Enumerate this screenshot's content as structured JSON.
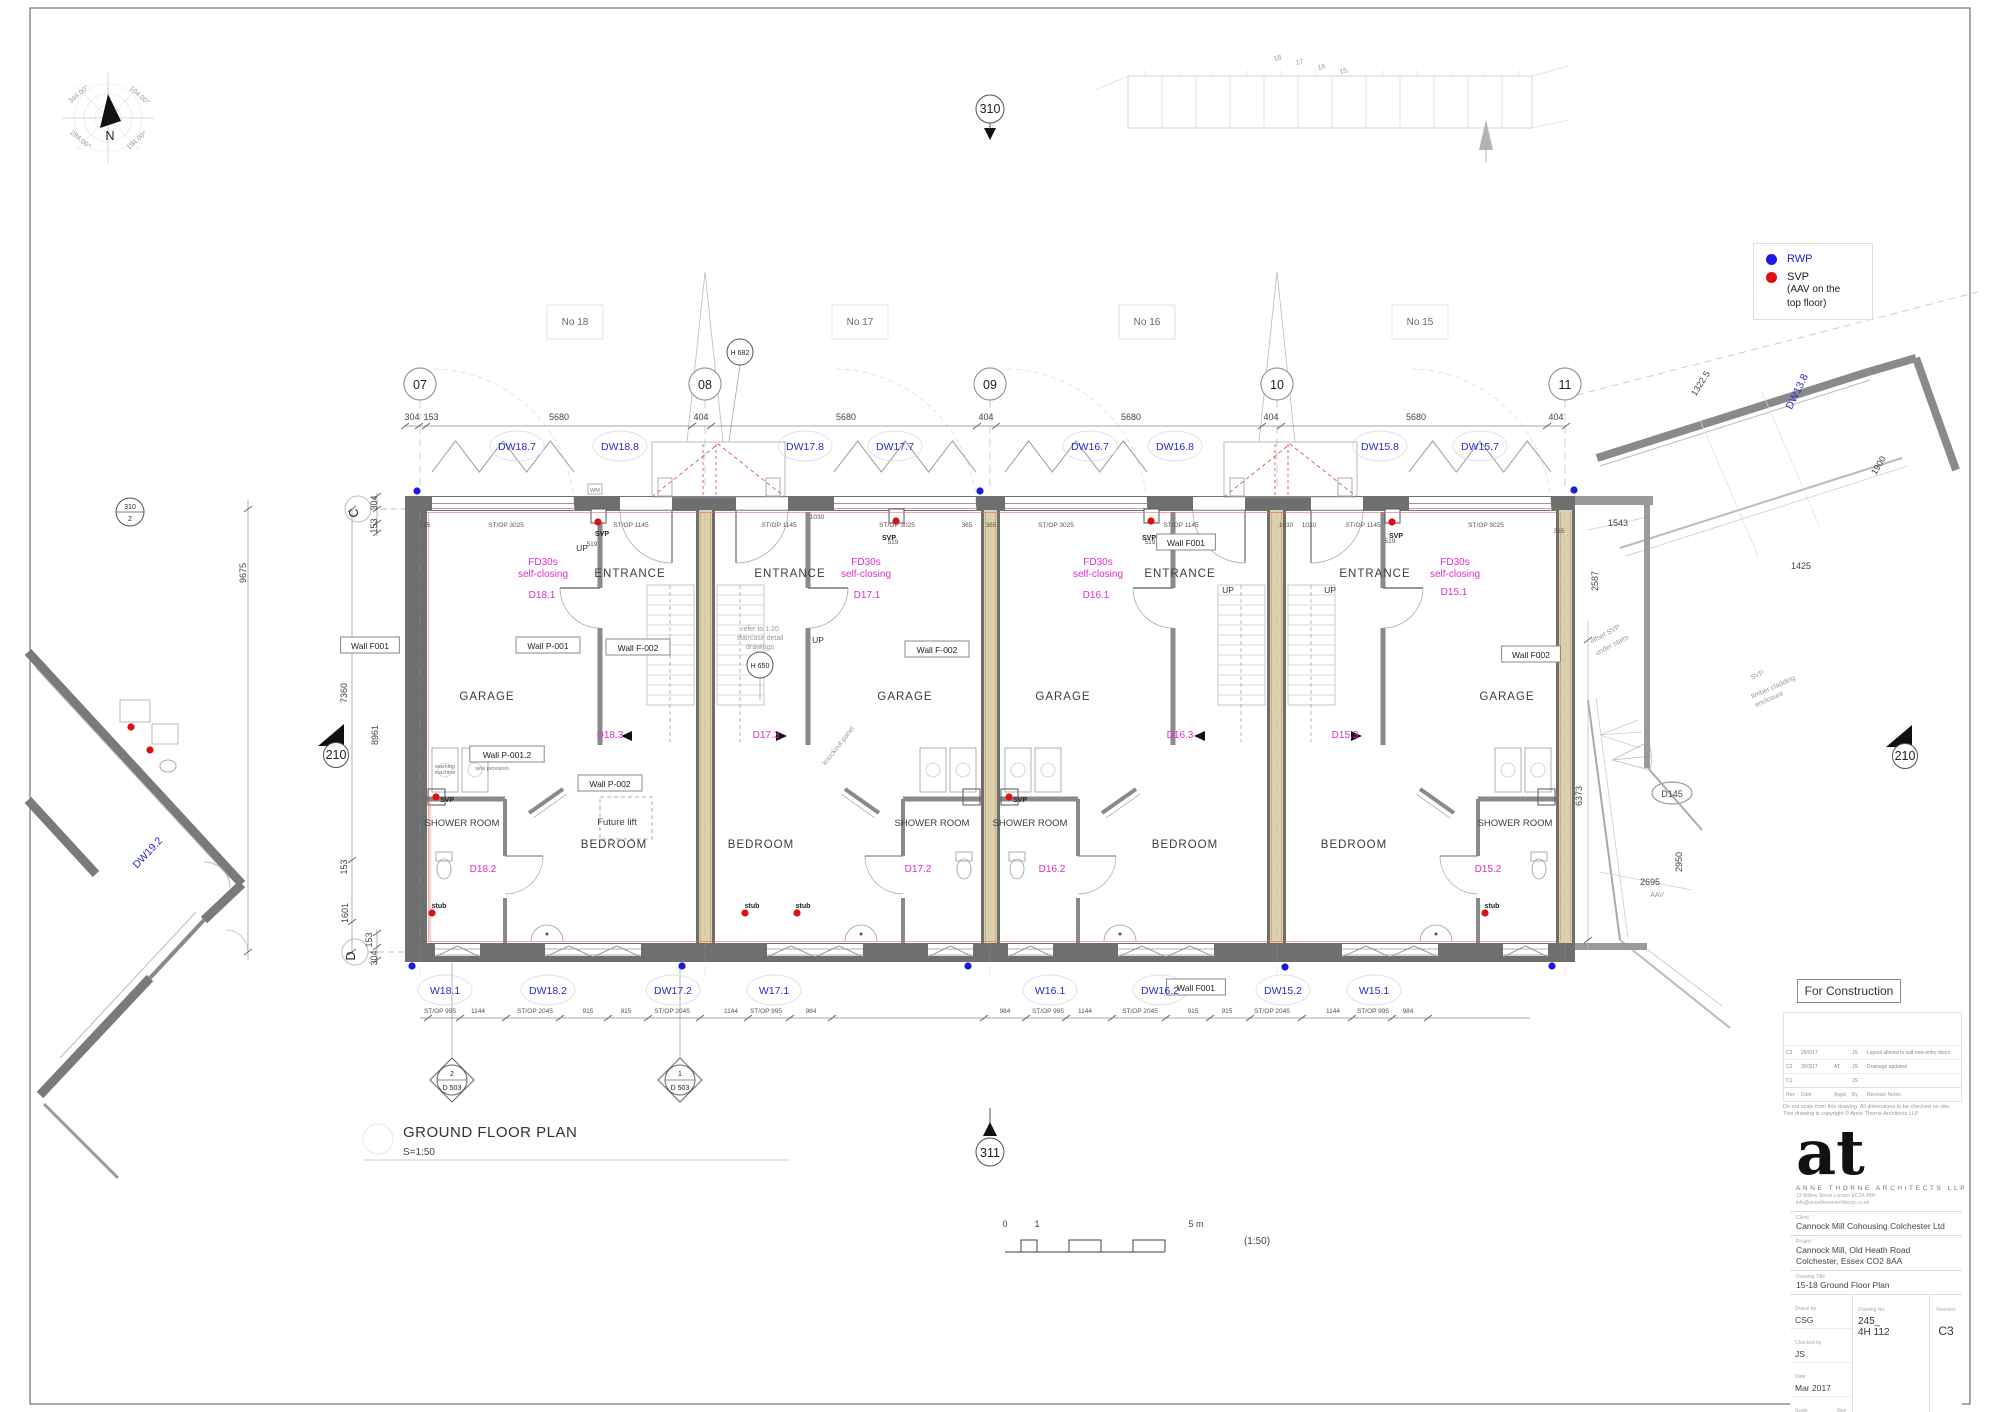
{
  "drawing": {
    "plan_title": "GROUND FLOOR PLAN",
    "plan_scale": "S=1:50",
    "scale_note": "(1:50)"
  },
  "legend": {
    "rwp_label": "RWP",
    "svp_label": "SVP",
    "svp_note1": "(AAV on the",
    "svp_note2": "top floor)",
    "rwp_color": "#1a1ae0",
    "svp_color": "#dd1111"
  },
  "titleblock": {
    "status": "For Construction",
    "logo": "at",
    "firm": "ANNE THORNE ARCHITECTS LLP",
    "address1": "13 Willow Street London EC2A 4BH",
    "address2": "info@annethornearchitects.co.uk",
    "client_label": "Client",
    "client": "Cannock Mill Cohousing Colchester Ltd",
    "project_label": "Project",
    "project1": "Cannock Mill, Old Heath Road",
    "project2": "Colchester, Essex CO2 8AA",
    "drawing_title_label": "Drawing Title",
    "drawing_title": "15-18 Ground Floor Plan",
    "drawn_label": "Drawn by",
    "drawn": "CSG",
    "checked_label": "Checked by",
    "checked": "JS",
    "date_label": "Date",
    "date": "Mar 2017",
    "scale_label": "Scale",
    "scale": "1:50",
    "size_label": "Size",
    "size": "A1",
    "number_label": "Drawing No.",
    "number1": "245_",
    "number2": "4H 112",
    "revision_label": "Revision",
    "revision": "C3"
  },
  "disclaimer1": "Do not scale from this drawing. All dimensions to be checked on site.",
  "disclaimer2": "This drawing is copyright © Anne Thorne Architects LLP",
  "revisions": {
    "headers": [
      "Rev",
      "Date",
      "Appd",
      "By",
      "Revision Notes"
    ],
    "rows": [
      {
        "rev": "C3",
        "date": "26/5/17",
        "appd": "",
        "by": "JS",
        "note": "Layout altered to suit new entry doors"
      },
      {
        "rev": "C2",
        "date": "30/3/17",
        "appd": "AT",
        "by": "JS",
        "note": "Drainage updated"
      },
      {
        "rev": "C1",
        "date": "",
        "appd": "",
        "by": "JS",
        "note": ""
      }
    ]
  },
  "wall_labels": [
    {
      "t": "Wall F001",
      "x": 370,
      "y": 648
    },
    {
      "t": "Wall P-001",
      "x": 548,
      "y": 648
    },
    {
      "t": "Wall F-002",
      "x": 638,
      "y": 650
    },
    {
      "t": "Wall F-002",
      "x": 937,
      "y": 652
    },
    {
      "t": "Wall F001",
      "x": 1186,
      "y": 545
    },
    {
      "t": "Wall F002",
      "x": 1531,
      "y": 657
    },
    {
      "t": "Wall P-001.2",
      "x": 507,
      "y": 757
    },
    {
      "t": "Wall P-002",
      "x": 610,
      "y": 786
    },
    {
      "t": "Wall F001",
      "x": 1196,
      "y": 990
    }
  ],
  "annotations": [
    {
      "t": "304",
      "x": 412,
      "y": 420,
      "c": "dim"
    },
    {
      "t": "153",
      "x": 431,
      "y": 420,
      "c": "dim"
    },
    {
      "t": "5680",
      "x": 559,
      "y": 420,
      "c": "dim"
    },
    {
      "t": "404",
      "x": 701,
      "y": 420,
      "c": "dim"
    },
    {
      "t": "5680",
      "x": 846,
      "y": 420,
      "c": "dim"
    },
    {
      "t": "404",
      "x": 986,
      "y": 420,
      "c": "dim"
    },
    {
      "t": "5680",
      "x": 1131,
      "y": 420,
      "c": "dim"
    },
    {
      "t": "404",
      "x": 1271,
      "y": 420,
      "c": "dim"
    },
    {
      "t": "5680",
      "x": 1416,
      "y": 420,
      "c": "dim"
    },
    {
      "t": "404",
      "x": 1556,
      "y": 420,
      "c": "dim"
    },
    {
      "t": "DW18.7",
      "x": 517,
      "y": 450,
      "c": "tag"
    },
    {
      "t": "DW18.8",
      "x": 620,
      "y": 450,
      "c": "tag"
    },
    {
      "t": "DW17.8",
      "x": 805,
      "y": 450,
      "c": "tag"
    },
    {
      "t": "DW17.7",
      "x": 895,
      "y": 450,
      "c": "tag"
    },
    {
      "t": "DW16.7",
      "x": 1090,
      "y": 450,
      "c": "tag"
    },
    {
      "t": "DW16.8",
      "x": 1175,
      "y": 450,
      "c": "tag"
    },
    {
      "t": "DW15.8",
      "x": 1380,
      "y": 450,
      "c": "tag"
    },
    {
      "t": "DW15.7",
      "x": 1480,
      "y": 450,
      "c": "tag"
    },
    {
      "t": "W18.1",
      "x": 445,
      "y": 994,
      "c": "tag"
    },
    {
      "t": "DW18.2",
      "x": 548,
      "y": 994,
      "c": "tag"
    },
    {
      "t": "DW17.2",
      "x": 673,
      "y": 994,
      "c": "tag"
    },
    {
      "t": "W17.1",
      "x": 774,
      "y": 994,
      "c": "tag"
    },
    {
      "t": "W16.1",
      "x": 1050,
      "y": 994,
      "c": "tag"
    },
    {
      "t": "DW16.2",
      "x": 1160,
      "y": 994,
      "c": "tag"
    },
    {
      "t": "DW15.2",
      "x": 1283,
      "y": 994,
      "c": "tag"
    },
    {
      "t": "W15.1",
      "x": 1374,
      "y": 994,
      "c": "tag"
    },
    {
      "t": "DW19.2",
      "x": 150,
      "y": 855,
      "c": "tag",
      "r": -47
    },
    {
      "t": "DW13.8",
      "x": 1800,
      "y": 393,
      "c": "tag",
      "r": -64
    },
    {
      "t": "No 18",
      "x": 575,
      "y": 325,
      "c": "no"
    },
    {
      "t": "No 17",
      "x": 860,
      "y": 325,
      "c": "no"
    },
    {
      "t": "No 16",
      "x": 1147,
      "y": 325,
      "c": "no"
    },
    {
      "t": "No 15",
      "x": 1420,
      "y": 325,
      "c": "no"
    },
    {
      "t": "115",
      "x": 425,
      "y": 527,
      "c": "tn"
    },
    {
      "t": "ST/OP 3025",
      "x": 506,
      "y": 527,
      "c": "tn"
    },
    {
      "t": "ST/OP 1145",
      "x": 631,
      "y": 527,
      "c": "tn"
    },
    {
      "t": "ST/OP 1145",
      "x": 779,
      "y": 527,
      "c": "tn"
    },
    {
      "t": "1030",
      "x": 817,
      "y": 519,
      "c": "tn"
    },
    {
      "t": "ST/OP 3025",
      "x": 897,
      "y": 527,
      "c": "tn"
    },
    {
      "t": "365",
      "x": 967,
      "y": 527,
      "c": "tn"
    },
    {
      "t": "365",
      "x": 991,
      "y": 527,
      "c": "tn"
    },
    {
      "t": "ST/OP 3025",
      "x": 1056,
      "y": 527,
      "c": "tn"
    },
    {
      "t": "ST/OP 1145",
      "x": 1181,
      "y": 527,
      "c": "tn"
    },
    {
      "t": "1030",
      "x": 1286,
      "y": 527,
      "c": "tn"
    },
    {
      "t": "1030",
      "x": 1309,
      "y": 527,
      "c": "tn"
    },
    {
      "t": "ST/OP 1145",
      "x": 1363,
      "y": 527,
      "c": "tn"
    },
    {
      "t": "ST/OP 3025",
      "x": 1486,
      "y": 527,
      "c": "tn"
    },
    {
      "t": "365",
      "x": 1559,
      "y": 533,
      "c": "tn"
    },
    {
      "t": "519",
      "x": 592,
      "y": 546,
      "c": "tn"
    },
    {
      "t": "519",
      "x": 893,
      "y": 544,
      "c": "tn"
    },
    {
      "t": "519",
      "x": 1150,
      "y": 544,
      "c": "tn"
    },
    {
      "t": "519",
      "x": 1390,
      "y": 543,
      "c": "tn"
    },
    {
      "t": "SVP",
      "x": 602,
      "y": 536,
      "c": "tnb"
    },
    {
      "t": "SVP",
      "x": 889,
      "y": 540,
      "c": "tnb"
    },
    {
      "t": "SVP",
      "x": 1149,
      "y": 540,
      "c": "tnb"
    },
    {
      "t": "SVP",
      "x": 1396,
      "y": 538,
      "c": "tnb"
    },
    {
      "t": "SVP",
      "x": 447,
      "y": 802,
      "c": "tnb"
    },
    {
      "t": "SVP",
      "x": 1020,
      "y": 802,
      "c": "tnb"
    },
    {
      "t": "stub",
      "x": 439,
      "y": 908,
      "c": "tnb"
    },
    {
      "t": "stub",
      "x": 752,
      "y": 908,
      "c": "tnb"
    },
    {
      "t": "stub",
      "x": 803,
      "y": 908,
      "c": "tnb"
    },
    {
      "t": "stub",
      "x": 1492,
      "y": 908,
      "c": "tnb"
    },
    {
      "t": "WM",
      "x": 595,
      "y": 492,
      "c": "tn5"
    },
    {
      "t": "washing",
      "x": 445,
      "y": 768,
      "c": "tn5"
    },
    {
      "t": "machine",
      "x": 445,
      "y": 774,
      "c": "tn5"
    },
    {
      "t": "sink provision",
      "x": 492,
      "y": 770,
      "c": "tn5"
    },
    {
      "t": "FD30s",
      "x": 543,
      "y": 565,
      "c": "mag"
    },
    {
      "t": "self-closing",
      "x": 543,
      "y": 577,
      "c": "mag"
    },
    {
      "t": "FD30s",
      "x": 866,
      "y": 565,
      "c": "mag"
    },
    {
      "t": "self-closing",
      "x": 866,
      "y": 577,
      "c": "mag"
    },
    {
      "t": "FD30s",
      "x": 1098,
      "y": 565,
      "c": "mag"
    },
    {
      "t": "self-closing",
      "x": 1098,
      "y": 577,
      "c": "mag"
    },
    {
      "t": "FD30s",
      "x": 1455,
      "y": 565,
      "c": "mag"
    },
    {
      "t": "self-closing",
      "x": 1455,
      "y": 577,
      "c": "mag"
    },
    {
      "t": "D18.1",
      "x": 542,
      "y": 598,
      "c": "mag"
    },
    {
      "t": "D17.1",
      "x": 867,
      "y": 598,
      "c": "mag"
    },
    {
      "t": "D16.1",
      "x": 1096,
      "y": 598,
      "c": "mag"
    },
    {
      "t": "D15.1",
      "x": 1454,
      "y": 595,
      "c": "mag"
    },
    {
      "t": "D18.3",
      "x": 610,
      "y": 738,
      "c": "mag"
    },
    {
      "t": "D17.3",
      "x": 766,
      "y": 738,
      "c": "mag"
    },
    {
      "t": "D16.3",
      "x": 1180,
      "y": 738,
      "c": "mag"
    },
    {
      "t": "D15.3",
      "x": 1345,
      "y": 738,
      "c": "mag"
    },
    {
      "t": "D18.2",
      "x": 483,
      "y": 872,
      "c": "mag"
    },
    {
      "t": "D17.2",
      "x": 918,
      "y": 872,
      "c": "mag"
    },
    {
      "t": "D16.2",
      "x": 1052,
      "y": 872,
      "c": "mag"
    },
    {
      "t": "D15.2",
      "x": 1488,
      "y": 872,
      "c": "mag"
    },
    {
      "t": "GARAGE",
      "x": 487,
      "y": 700,
      "c": "room"
    },
    {
      "t": "GARAGE",
      "x": 905,
      "y": 700,
      "c": "room"
    },
    {
      "t": "GARAGE",
      "x": 1063,
      "y": 700,
      "c": "room"
    },
    {
      "t": "GARAGE",
      "x": 1507,
      "y": 700,
      "c": "room"
    },
    {
      "t": "ENTRANCE",
      "x": 630,
      "y": 577,
      "c": "room"
    },
    {
      "t": "ENTRANCE",
      "x": 790,
      "y": 577,
      "c": "room"
    },
    {
      "t": "ENTRANCE",
      "x": 1180,
      "y": 577,
      "c": "room"
    },
    {
      "t": "ENTRANCE",
      "x": 1375,
      "y": 577,
      "c": "room"
    },
    {
      "t": "SHOWER ROOM",
      "x": 462,
      "y": 826,
      "c": "roomsm"
    },
    {
      "t": "SHOWER ROOM",
      "x": 932,
      "y": 826,
      "c": "roomsm"
    },
    {
      "t": "SHOWER ROOM",
      "x": 1030,
      "y": 826,
      "c": "roomsm"
    },
    {
      "t": "SHOWER ROOM",
      "x": 1515,
      "y": 826,
      "c": "roomsm"
    },
    {
      "t": "BEDROOM",
      "x": 614,
      "y": 848,
      "c": "room"
    },
    {
      "t": "BEDROOM",
      "x": 761,
      "y": 848,
      "c": "room"
    },
    {
      "t": "BEDROOM",
      "x": 1185,
      "y": 848,
      "c": "room"
    },
    {
      "t": "BEDROOM",
      "x": 1354,
      "y": 848,
      "c": "room"
    },
    {
      "t": "Future lift",
      "x": 617,
      "y": 825,
      "c": "roomsm"
    },
    {
      "t": "UP",
      "x": 582,
      "y": 551,
      "c": "up"
    },
    {
      "t": "UP",
      "x": 818,
      "y": 643,
      "c": "up"
    },
    {
      "t": "UP",
      "x": 1228,
      "y": 593,
      "c": "up"
    },
    {
      "t": "UP",
      "x": 1330,
      "y": 593,
      "c": "up"
    },
    {
      "t": "refer to 1:20",
      "x": 760,
      "y": 631,
      "c": "tng"
    },
    {
      "t": "staircase detail",
      "x": 760,
      "y": 640,
      "c": "tng"
    },
    {
      "t": "drawings",
      "x": 760,
      "y": 649,
      "c": "tng"
    },
    {
      "t": "knockout panel",
      "x": 840,
      "y": 747,
      "c": "tng",
      "r": -52
    },
    {
      "t": "304",
      "x": 377,
      "y": 503,
      "c": "dimv",
      "r": -90
    },
    {
      "t": "153",
      "x": 377,
      "y": 526,
      "c": "dimv",
      "r": -90
    },
    {
      "t": "9675",
      "x": 246,
      "y": 573,
      "c": "dimv",
      "r": -90
    },
    {
      "t": "7360",
      "x": 347,
      "y": 693,
      "c": "dimv",
      "r": -90
    },
    {
      "t": "8961",
      "x": 378,
      "y": 735,
      "c": "dimv",
      "r": -90
    },
    {
      "t": "153",
      "x": 347,
      "y": 867,
      "c": "dimv",
      "r": -90
    },
    {
      "t": "1601",
      "x": 348,
      "y": 913,
      "c": "dimv",
      "r": -90
    },
    {
      "t": "153",
      "x": 372,
      "y": 940,
      "c": "dimv",
      "r": -90
    },
    {
      "t": "304",
      "x": 377,
      "y": 958,
      "c": "dimv",
      "r": -90
    },
    {
      "t": "ST/OP 995",
      "x": 440,
      "y": 1013,
      "c": "tn"
    },
    {
      "t": "1144",
      "x": 478,
      "y": 1013,
      "c": "tn"
    },
    {
      "t": "ST/OP 2045",
      "x": 535,
      "y": 1013,
      "c": "tn"
    },
    {
      "t": "915",
      "x": 588,
      "y": 1013,
      "c": "tn"
    },
    {
      "t": "915",
      "x": 626,
      "y": 1013,
      "c": "tn"
    },
    {
      "t": "ST/OP 2045",
      "x": 672,
      "y": 1013,
      "c": "tn"
    },
    {
      "t": "1144",
      "x": 731,
      "y": 1013,
      "c": "tn"
    },
    {
      "t": "ST/OP 995",
      "x": 766,
      "y": 1013,
      "c": "tn"
    },
    {
      "t": "984",
      "x": 811,
      "y": 1013,
      "c": "tn"
    },
    {
      "t": "984",
      "x": 1005,
      "y": 1013,
      "c": "tn"
    },
    {
      "t": "ST/OP 995",
      "x": 1048,
      "y": 1013,
      "c": "tn"
    },
    {
      "t": "1144",
      "x": 1085,
      "y": 1013,
      "c": "tn"
    },
    {
      "t": "ST/OP 2045",
      "x": 1140,
      "y": 1013,
      "c": "tn"
    },
    {
      "t": "915",
      "x": 1193,
      "y": 1013,
      "c": "tn"
    },
    {
      "t": "915",
      "x": 1227,
      "y": 1013,
      "c": "tn"
    },
    {
      "t": "ST/OP 2045",
      "x": 1272,
      "y": 1013,
      "c": "tn"
    },
    {
      "t": "1144",
      "x": 1333,
      "y": 1013,
      "c": "tn"
    },
    {
      "t": "ST/OP 995",
      "x": 1373,
      "y": 1013,
      "c": "tn"
    },
    {
      "t": "984",
      "x": 1408,
      "y": 1013,
      "c": "tn"
    },
    {
      "t": "1543",
      "x": 1618,
      "y": 526,
      "c": "dim"
    },
    {
      "t": "2587",
      "x": 1598,
      "y": 581,
      "c": "dimv",
      "r": -90
    },
    {
      "t": "1322.5",
      "x": 1703,
      "y": 385,
      "c": "dim",
      "r": -58
    },
    {
      "t": "1900",
      "x": 1881,
      "y": 467,
      "c": "dim",
      "r": -58
    },
    {
      "t": "1425",
      "x": 1801,
      "y": 569,
      "c": "dim"
    },
    {
      "t": "6373",
      "x": 1582,
      "y": 796,
      "c": "dimv",
      "r": -90
    },
    {
      "t": "2695",
      "x": 1650,
      "y": 885,
      "c": "dim"
    },
    {
      "t": "2950",
      "x": 1682,
      "y": 862,
      "c": "dimv",
      "r": -90
    },
    {
      "t": "AAV",
      "x": 1657,
      "y": 897,
      "c": "tng"
    },
    {
      "t": "D145",
      "x": 1672,
      "y": 797,
      "c": "dim"
    },
    {
      "t": "offset SVP",
      "x": 1606,
      "y": 636,
      "c": "tng",
      "r": -28
    },
    {
      "t": "under stairs",
      "x": 1613,
      "y": 647,
      "c": "tng",
      "r": -28
    },
    {
      "t": "SVP",
      "x": 1758,
      "y": 677,
      "c": "tng",
      "r": -24
    },
    {
      "t": "timber cladding",
      "x": 1774,
      "y": 689,
      "c": "tng",
      "r": -24
    },
    {
      "t": "enclosure",
      "x": 1770,
      "y": 701,
      "c": "tng",
      "r": -24
    },
    {
      "t": "18",
      "x": 1278,
      "y": 60,
      "c": "tng",
      "r": -14
    },
    {
      "t": "17",
      "x": 1300,
      "y": 64,
      "c": "tng",
      "r": -14
    },
    {
      "t": "16",
      "x": 1322,
      "y": 69,
      "c": "tng",
      "r": -14
    },
    {
      "t": "15",
      "x": 1344,
      "y": 73,
      "c": "tng",
      "r": -14
    },
    {
      "t": "346.00°",
      "x": 80,
      "y": 96,
      "c": "tng",
      "r": -40
    },
    {
      "t": "104.00°",
      "x": 138,
      "y": 97,
      "c": "tng",
      "r": 40
    },
    {
      "t": "284.00°",
      "x": 79,
      "y": 141,
      "c": "tng",
      "r": 40
    },
    {
      "t": "194.00°",
      "x": 138,
      "y": 142,
      "c": "tng",
      "r": -40
    },
    {
      "t": "N",
      "x": 110,
      "y": 140,
      "c": "bub"
    },
    {
      "t": "07",
      "x": 420,
      "y": 389,
      "c": "bub"
    },
    {
      "t": "08",
      "x": 705,
      "y": 389,
      "c": "bub"
    },
    {
      "t": "09",
      "x": 990,
      "y": 389,
      "c": "bub"
    },
    {
      "t": "10",
      "x": 1277,
      "y": 389,
      "c": "bub"
    },
    {
      "t": "11",
      "x": 1565,
      "y": 389,
      "c": "bub"
    },
    {
      "t": "C",
      "x": 358,
      "y": 513,
      "c": "bub",
      "r": -90
    },
    {
      "t": "D",
      "x": 355,
      "y": 956,
      "c": "bub",
      "r": -90
    },
    {
      "t": "310",
      "x": 990,
      "y": 113,
      "c": "bub"
    },
    {
      "t": "311",
      "x": 990,
      "y": 1157,
      "c": "bub"
    },
    {
      "t": "210",
      "x": 336,
      "y": 759,
      "c": "bub"
    },
    {
      "t": "210",
      "x": 1905,
      "y": 760,
      "c": "bub"
    },
    {
      "t": "H 682",
      "x": 740,
      "y": 355,
      "c": "bubs"
    },
    {
      "t": "H 650",
      "x": 760,
      "y": 668,
      "c": "bubs"
    },
    {
      "t": "310",
      "x": 130,
      "y": 509,
      "c": "bubs"
    },
    {
      "t": "2",
      "x": 130,
      "y": 521,
      "c": "bubs"
    },
    {
      "t": "2",
      "x": 452,
      "y": 1076,
      "c": "bubs"
    },
    {
      "t": "D 503",
      "x": 452,
      "y": 1090,
      "c": "bubs"
    },
    {
      "t": "1",
      "x": 680,
      "y": 1076,
      "c": "bubs"
    },
    {
      "t": "D 503",
      "x": 680,
      "y": 1090,
      "c": "bubs"
    },
    {
      "t": "GROUND FLOOR PLAN",
      "x": 403,
      "y": 1137,
      "c": "title",
      "a": "s"
    },
    {
      "t": "S=1:50",
      "x": 403,
      "y": 1155,
      "c": "sub",
      "a": "s"
    },
    {
      "t": "0",
      "x": 1005,
      "y": 1227,
      "c": "dim"
    },
    {
      "t": "1",
      "x": 1037,
      "y": 1227,
      "c": "dim"
    },
    {
      "t": "5 m",
      "x": 1196,
      "y": 1227,
      "c": "dim"
    },
    {
      "t": "(1:50)",
      "x": 1257,
      "y": 1244,
      "c": "sub"
    }
  ]
}
